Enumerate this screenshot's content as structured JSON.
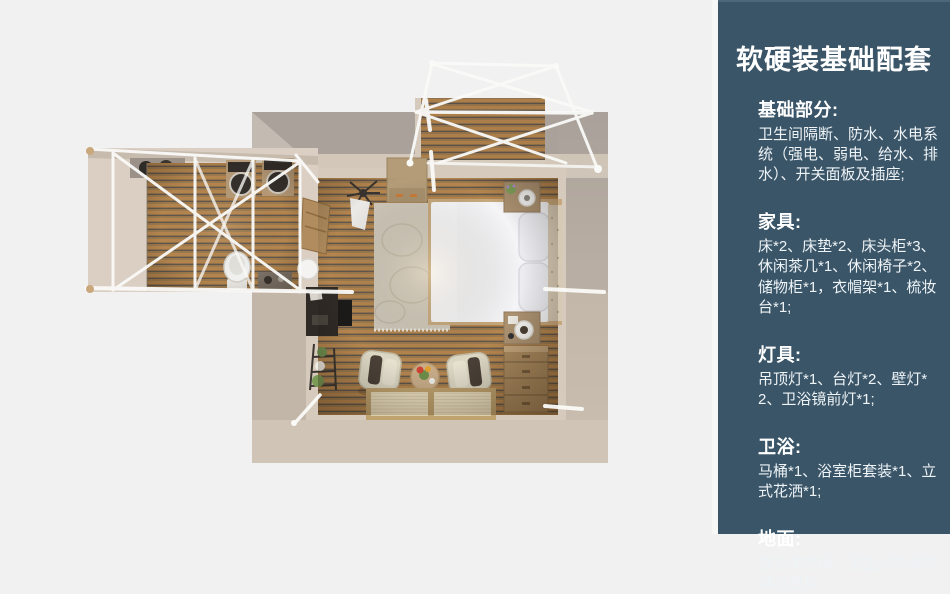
{
  "panel": {
    "title": "软硬装基础配套",
    "sections": [
      {
        "heading": "基础部分:",
        "body": "卫生间隔断、防水、水电系统（强电、弱电、给水、排水）、开关面板及插座;"
      },
      {
        "heading": "家具:",
        "body": "床*2、床垫*2、床头柜*3、休闲茶几*1、休闲椅子*2、储物柜*1，衣帽架*1、梳妆台*1;"
      },
      {
        "heading": "灯具:",
        "body": "吊顶灯*1、台灯*2、壁灯*2、卫浴镜前灯*1;"
      },
      {
        "heading": "卫浴:",
        "body": "马桶*1、浴室柜套装*1、立式花洒*1;"
      },
      {
        "heading": "地面:",
        "body": "强化木地板、卫生间防滑防潮石塑板;"
      }
    ]
  },
  "floorplan": {
    "description": "Top-down 3D render of a guest suite: main bedroom with double bed, rug, dresser, two lounge chairs with tea table and floor mats, storage chest; left bathroom wing with twin basin vanities, toilet and white truss frame; top entry deck with white truss canopy"
  },
  "theme": {
    "bg": "#f1f1f1",
    "panel-bg": "#3a5568",
    "panel-edge": "#f7f7f5",
    "panel-top": "#4d6678",
    "panel-text": "#ffffff",
    "wall": "#c2b6a8",
    "wall-dark": "#a9a19a",
    "wall-light": "#d5cabc",
    "wall-bottom": "#d0c4b6",
    "wing-floor": "#dacfc2",
    "wood": "#b5854e",
    "wood-dark": "#60564a",
    "wood-mid": "#9b7b4e",
    "truss": "#fafaf8",
    "linen": "#f5f5f7",
    "bed-frame": "#c7a87c",
    "headboard": "#d7cab5",
    "rug": "#cfc8ba",
    "chair": "#ddd8c4",
    "cushion": "#4b4138",
    "mat-frame": "#bfa26e",
    "mat-fill": "#ecdfc0",
    "furn-wood": "#ab9170",
    "chest-wood": "#aa8a5f",
    "dresser-wood": "#b49c79",
    "dark-furn": "#2f2a26"
  }
}
